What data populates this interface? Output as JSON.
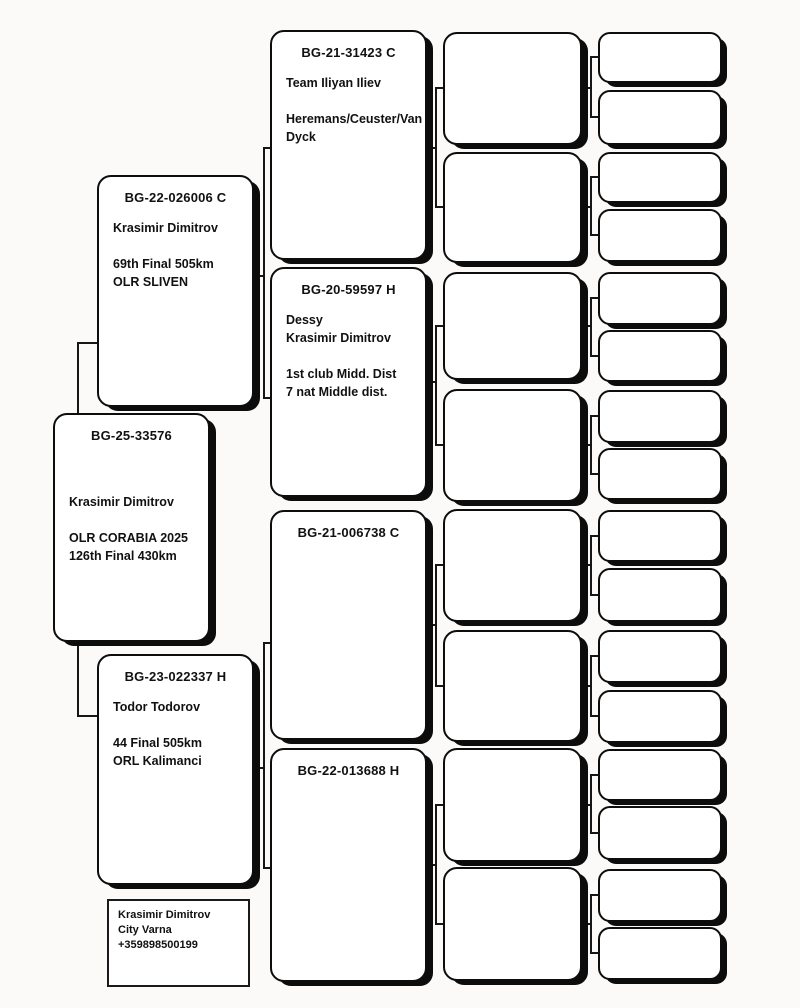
{
  "page": {
    "background": "#fbfaf8",
    "box_border_color": "#0d0d0d",
    "connector_color": "#161616"
  },
  "pedigree": {
    "subject": {
      "ring": "BG-25-33576",
      "lines": [
        "",
        "",
        "Krasimir Dimitrov",
        "",
        "OLR CORABIA 2025",
        "126th Final 430km"
      ]
    },
    "father": {
      "ring": "BG-22-026006 C",
      "lines": [
        "Krasimir Dimitrov",
        "",
        "69th Final 505km",
        "OLR SLIVEN"
      ]
    },
    "mother": {
      "ring": "BG-23-022337 H",
      "lines": [
        "Todor Todorov",
        "",
        "44 Final 505km",
        "ORL Kalimanci"
      ]
    },
    "grandparents": [
      {
        "ring": "BG-21-31423 C",
        "lines": [
          "Team Iliyan Iliev",
          "",
          "Heremans/Ceuster/Van Dyck"
        ]
      },
      {
        "ring": "BG-20-59597 H",
        "lines": [
          "Dessy",
          "Krasimir Dimitrov",
          "",
          "1st club Midd. Dist",
          "7 nat Middle dist."
        ]
      },
      {
        "ring": "BG-21-006738 C",
        "lines": []
      },
      {
        "ring": "BG-22-013688 H",
        "lines": []
      }
    ],
    "contact": {
      "name": "Krasimir Dimitrov",
      "city": "City Varna",
      "phone": "+359898500199"
    }
  }
}
